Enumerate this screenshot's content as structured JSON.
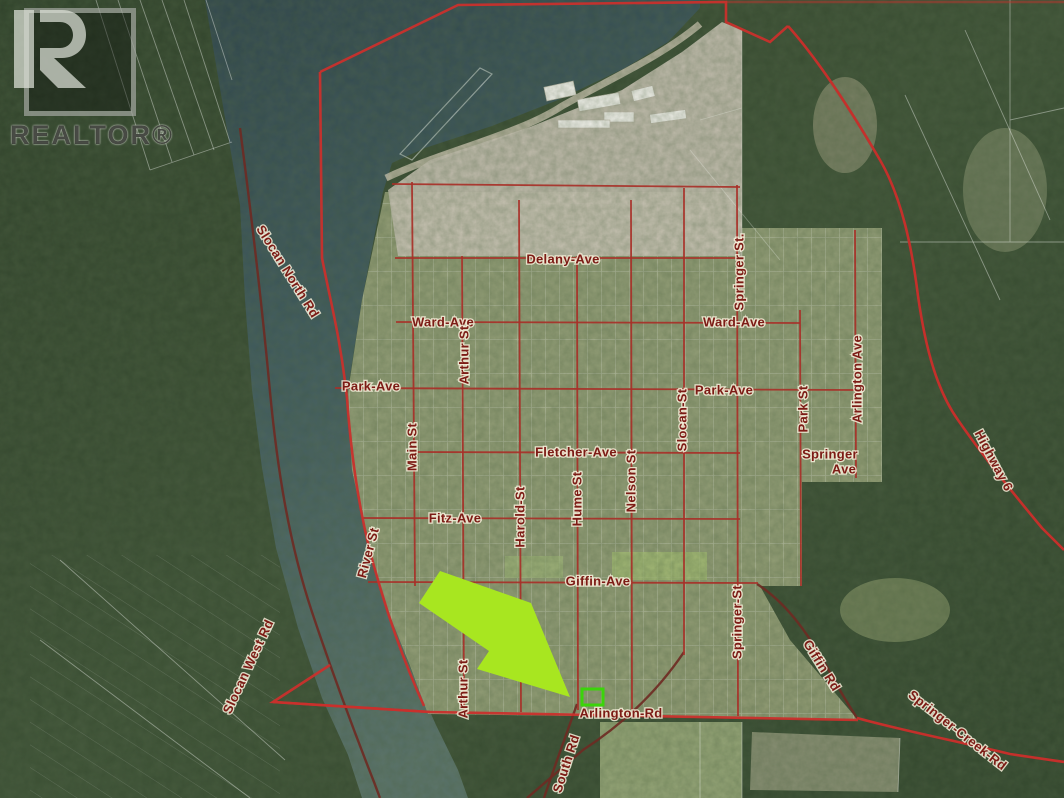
{
  "branding": {
    "logo_text": "REALTOR®"
  },
  "map": {
    "description": "Aerial real-estate map of Slocan townsite with property boundary overlay and highlighted lot on Arlington Rd",
    "labels": {
      "delany_ave": "Delany-Ave",
      "ward_ave_w": "Ward-Ave",
      "ward_ave_e": "Ward-Ave",
      "park_ave_w": "Park-Ave",
      "park_ave_e": "Park-Ave",
      "fletcher_ave": "Fletcher-Ave",
      "fitz_ave": "Fitz-Ave",
      "giffin_ave": "Giffin-Ave",
      "springer_ave_line1": "Springer",
      "springer_ave_line2": "Ave",
      "arlington_rd": "Arlington-Rd",
      "springer_st_n": "Springer St.",
      "arthur_st_n": "Arthur St",
      "main_st": "Main St",
      "slocan_st": "Slocan-St",
      "park_st": "Park St",
      "arlington_ave": "Arlington Ave",
      "nelson_st": "Nelson St",
      "hume_st": "Hume St",
      "harold_st": "Harold-St",
      "springer_st_s": "Springer-St",
      "arthur_st_s": "Arthur St",
      "river_st": "River St",
      "south_rd": "South Rd",
      "slocan_north_rd": "Slocan North Rd",
      "slocan_west_rd": "Slocan West Rd",
      "highway_6": "Highway 6",
      "giffin_rd": "Giffin Rd",
      "springer_creek_rd": "Springer-Creek-Rd"
    },
    "colors": {
      "boundary_red": "#c9302c",
      "street_red": "#a83028",
      "rural_road_maroon": "#6e2a22",
      "label_maroon": "#7c1b15",
      "arrow_green": "#a8e620",
      "highlight_green": "#3bd40a",
      "water_teal": "#3d585c",
      "forest_green": "#35472f",
      "gravel_tan": "#c8c2b4"
    },
    "highlight": {
      "type": "rectangle-outline",
      "meaning": "subject property"
    },
    "arrow": {
      "meaning": "points to subject property"
    }
  }
}
